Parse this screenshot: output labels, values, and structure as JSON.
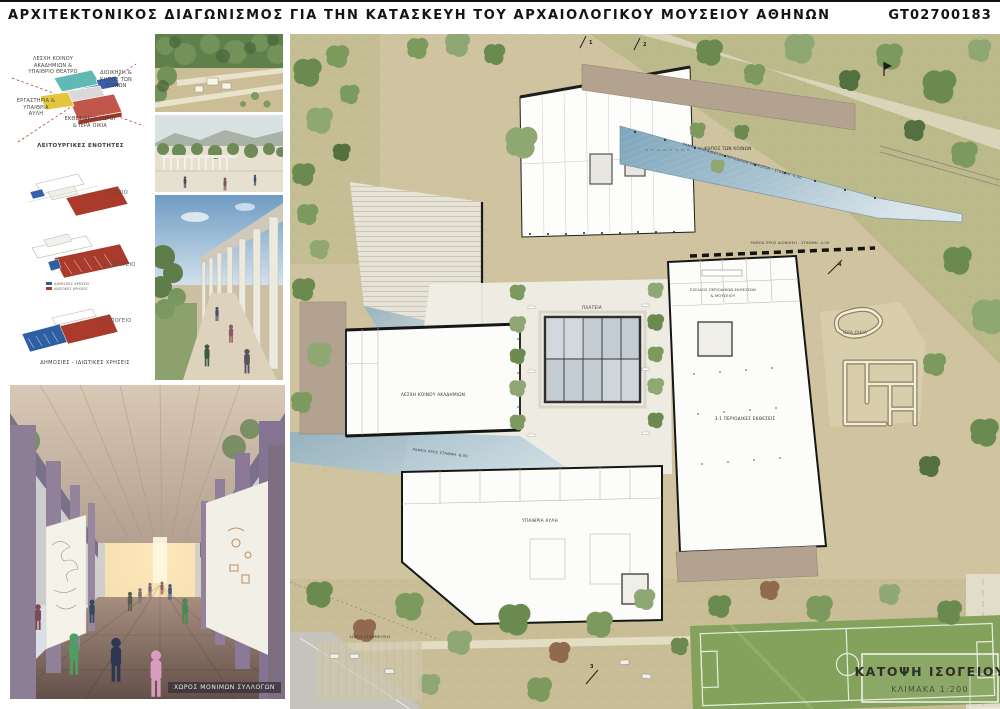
{
  "header": {
    "title": "ΑΡΧΙΤΕΚΤΟΝΙΚΟΣ ΔΙΑΓΩΝΙΣΜΟΣ ΓΙΑ ΤΗΝ ΚΑΤΑΣΚΕΥΗ ΤΟΥ ΑΡΧΑΙΟΛΟΓΙΚΟΥ ΜΟΥΣΕΙΟΥ ΑΘΗΝΩΝ",
    "code": "GT02700183"
  },
  "concept": {
    "labels": {
      "top_left": "ΛΕΣΧΗ ΚΟΙΝΟΥ ΑΚΑΔΗΜΙΩΝ & ΥΠΑΙΘΡΙΟ ΘΕΑΤΡΟ",
      "right": "ΔΙΟΙΚΗΣΗ & ΚΗΠΟΣ ΤΩΝ ΚΟΙΝΩΝ",
      "left": "ΕΡΓΑΣΤΗΡΙΑ & ΥΠΑΙΘΡΙΑ ΑΥΛΗ",
      "bottom": "ΕΚΘΕΣΙΑΚΟΙ ΧΩΡΟΙ & ΙΕΡΑ ΟΙΚΙΑ"
    },
    "caption": "ΛΕΙΤΟΥΡΓΙΚΕΣ ΕΝΟΤΗΤΕΣ"
  },
  "axons": {
    "levels": [
      {
        "label": "ΙΣΟΓΕΙΟ"
      },
      {
        "label": "Α' ΥΠΟΓΕΙΟ"
      },
      {
        "label": "Β' ΥΠΟΓΕΙΟ"
      }
    ],
    "legend": [
      {
        "label": "ΔΗΜΟΣΙΕΣ ΧΡΗΣΕΙΣ",
        "color": "#2e5fa3"
      },
      {
        "label": "ΙΔΙΩΤΙΚΕΣ ΧΡΗΣΕΙΣ",
        "color": "#a93a2c"
      }
    ],
    "caption": "ΔΗΜΟΣΙΕΣ - ΙΔΙΩΤΙΚΕΣ ΧΡΗΣΕΙΣ"
  },
  "render": {
    "caption": "ΧΩΡΟΣ ΜΟΝΙΜΩΝ ΣΥΛΛΟΓΩΝ"
  },
  "plan": {
    "title": "ΚΑΤΟΨΗ ΙΣΟΓΕΙΟΥ",
    "scale": "ΚΛΙΜΑΚΑ 1:200",
    "annotations": {
      "plaza": "ΠΛΑΤΕΙΑ",
      "sacred_house": "ΙΕΡΑ ΟΙΚΙΑ",
      "commons_garden": "ΚΗΠΟΣ ΤΩΝ ΚΟΙΝΩΝ",
      "academy_club": "ΛΕΣΧΗ ΚΟΙΝΟΥ ΑΚΑΔΗΜΙΩΝ",
      "entrance_line1": "ΕΙΣΟΔΟΣ ΠΕΡΙΟΔΙΚΩΝ ΕΚΘΕΣΕΩΝ",
      "entrance_line2": "& ΜΟΥΣΕΙΟΥ",
      "ramp_ne": "ΡΑΜΠΑ ΑΠΟ ΑΙΘΟΥΣΑ ΠΕΡΙΟΔΙΚΩΝ ΕΚΘΕΣΕΩΝ - ΣΤΑΘΜΗ -4.00",
      "ramp_admin": "ΡΑΜΠΑ ΠΡΟΣ ΔΙΟΙΚΗΣΗ - ΣΤΑΘΜΗ -4.00",
      "ramp_west": "ΡΑΜΠΑ ΠΡΟΣ ΣΤΑΘΜΗ -8.00",
      "courtyard": "ΥΠΑΙΘΡΙΑ ΑΥΛΗ",
      "exhibitions": "3.1 ΠΕΡΙΟΔΙΚΕΣ ΕΚΘΕΣΕΙΣ",
      "parking": "ΧΩΡΟΣ ΣΤΑΘΜΕΥΣΗΣ"
    },
    "section_marks": [
      "1",
      "2",
      "3",
      "4"
    ]
  },
  "colors": {
    "board_bg": "#ffffff",
    "ground_beige": "#cfc3a0",
    "olive_field": "#bcb98a",
    "pitch_green": "#84a25c",
    "glass_blue": "#7ea6bc",
    "mocha": "#b2a28f",
    "wall_black": "#161614",
    "concept_teal": "#62b8b2",
    "concept_blue": "#3a5fae",
    "concept_red": "#c0574a",
    "concept_yellow": "#e3c63e",
    "diagram_red": "#a93a2c",
    "diagram_blue": "#2e5fa3"
  }
}
